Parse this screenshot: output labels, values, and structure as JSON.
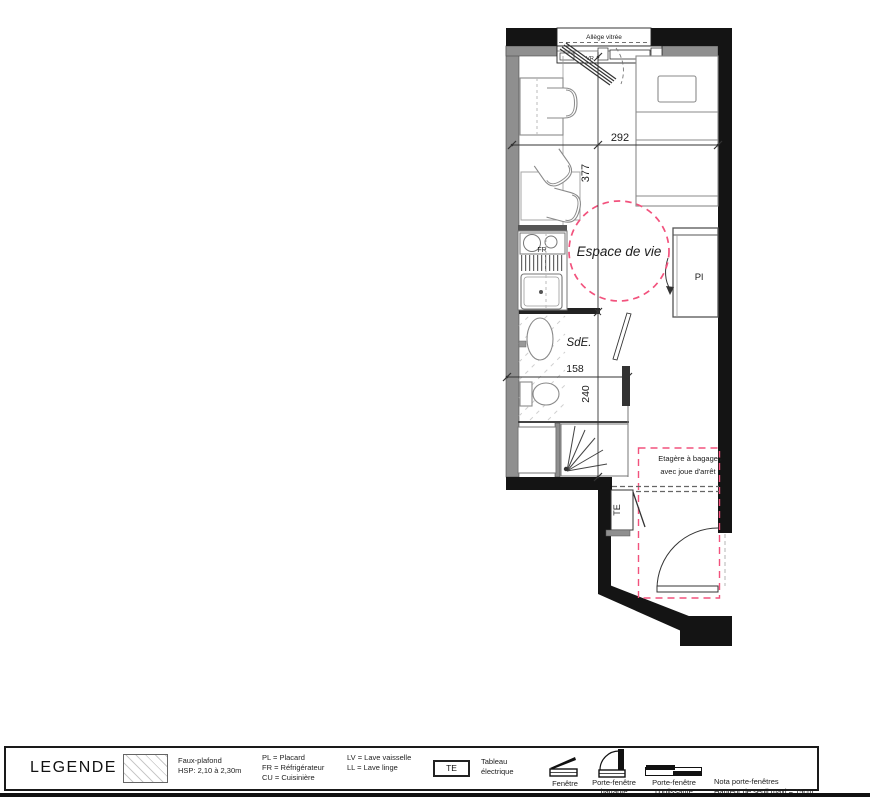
{
  "plan": {
    "window": {
      "allege": "Allège vitrée",
      "vr": "VR"
    },
    "rooms": {
      "living": "Espace de vie",
      "bathroom": "SdE.",
      "closet": "Pl"
    },
    "appliances": {
      "fridge": "FR",
      "electrical_panel": "TE"
    },
    "annotations": {
      "luggage_line1": "Etagère à bagages",
      "luggage_line2": "avec joue d'arrêt"
    },
    "dimensions": {
      "room_width": "292",
      "room_length": "377",
      "bath_width": "158",
      "bath_length": "240"
    },
    "colors": {
      "wall": "#141414",
      "wall_gray": "#8f8f8f",
      "accent_pink": "#f2527d"
    }
  },
  "legend": {
    "title": "LEGENDE",
    "faux_plafond_label": "Faux-plafond",
    "faux_plafond_hsp": "HSP: 2,10 à 2,30m",
    "abbreviations": [
      "PL = Placard",
      "FR = Réfrigérateur",
      "CU = Cuisinière",
      "LV = Lave vaisselle",
      "LL = Lave linge"
    ],
    "te_symbol": "TE",
    "te_label": [
      "Tableau",
      "électrique"
    ],
    "window_symbols": [
      {
        "line1": "Fenêtre",
        "line2": ""
      },
      {
        "line1": "Porte-fenêtre",
        "line2": "battante"
      },
      {
        "line1": "Porte-fenêtre",
        "line2": "coulissante"
      }
    ],
    "nota": [
      "Nota porte-fenêtres",
      "Hauteur de seuil maxi = 15cm"
    ]
  }
}
